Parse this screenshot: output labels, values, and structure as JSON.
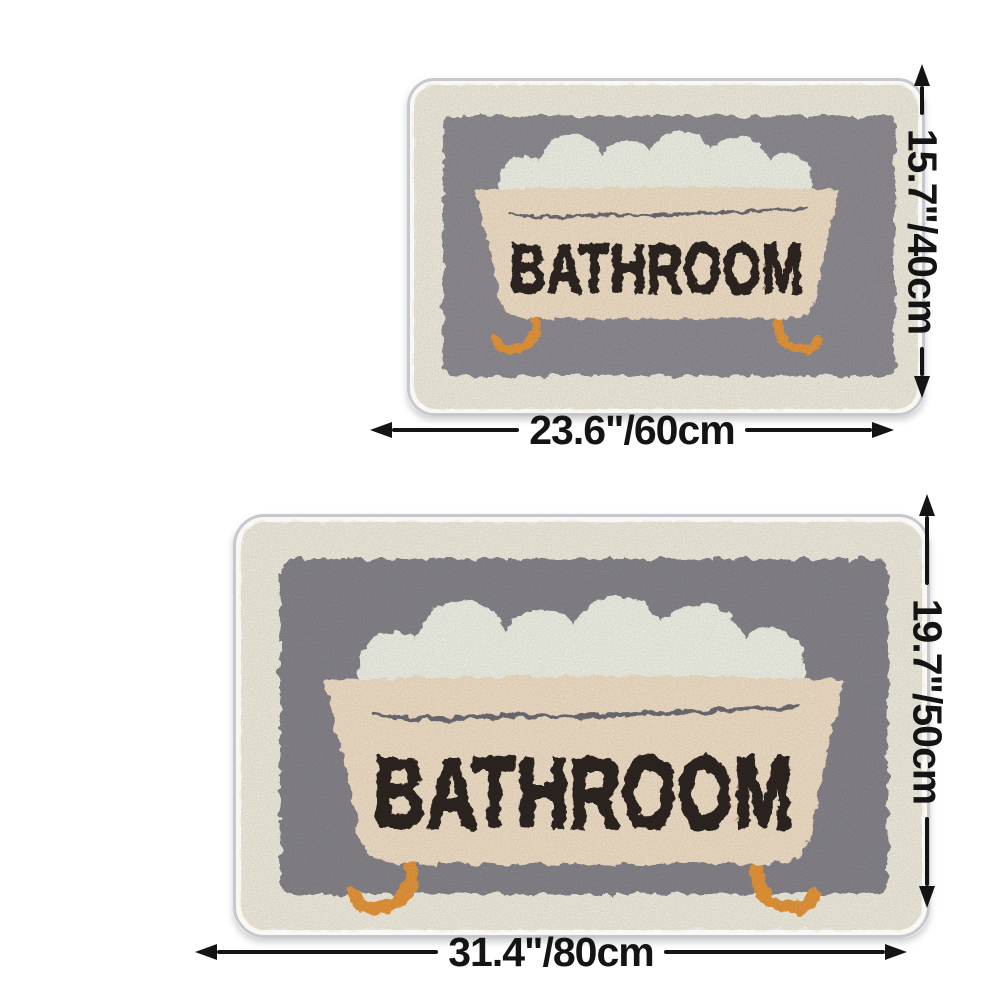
{
  "theme": {
    "bg": "#ffffff",
    "base": "#f9f8f4",
    "binding": "#c7c8ce",
    "fluff": "#f3efe1",
    "panel-small": "#908e94",
    "panel-large": "#88868c",
    "foam": "#f2f4e9",
    "tub": "#f4e2c9",
    "waterline": "#6f6d74",
    "tub-text": "#2e2620",
    "feet": "#e8973a",
    "dim": "#141414"
  },
  "rug_small": {
    "design_text": "BATHROOM",
    "width_label": "23.6\"/60cm",
    "height_label": "15.7\"/40cm"
  },
  "rug_large": {
    "design_text": "BATHROOM",
    "width_label": "31.4\"/80cm",
    "height_label": "19.7\"/50cm"
  }
}
